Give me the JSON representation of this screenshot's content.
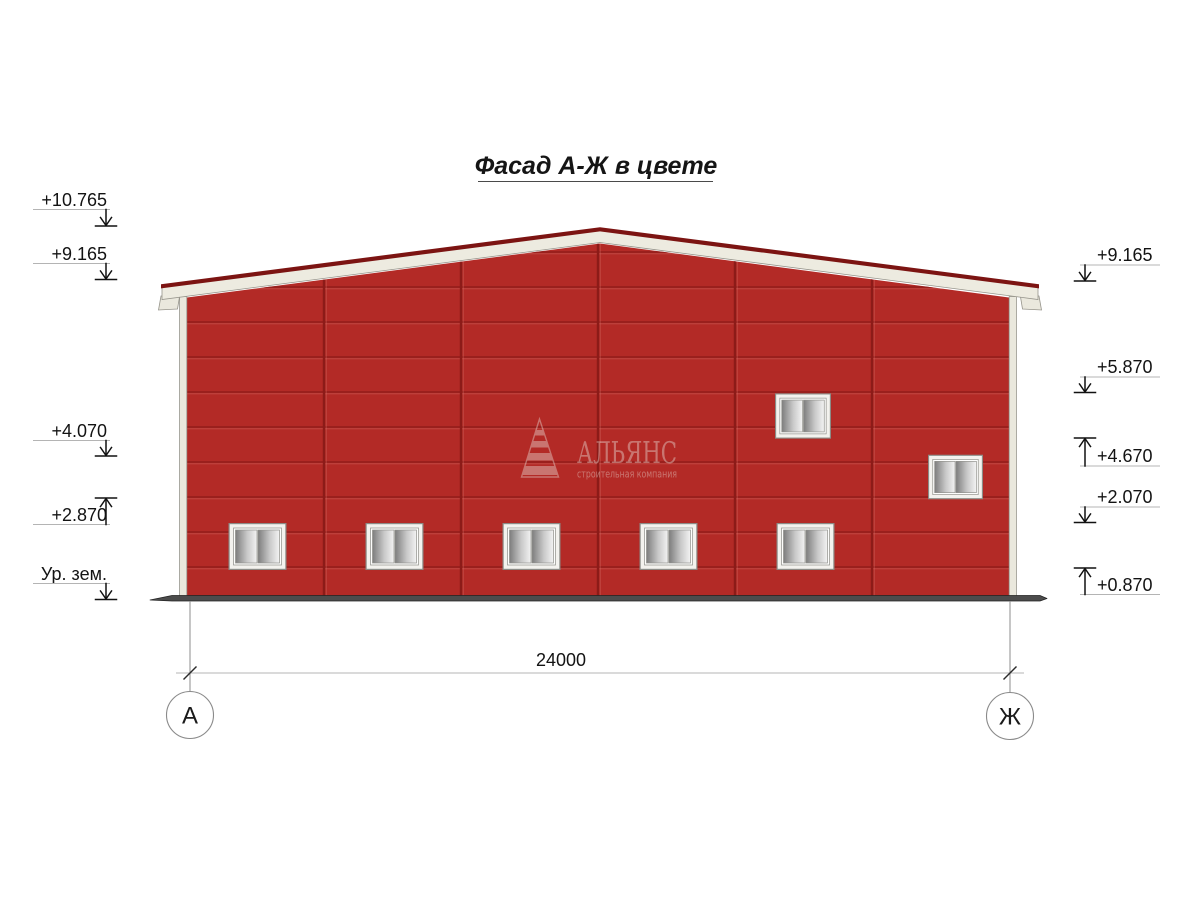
{
  "title": "Фасад А-Ж в цвете",
  "watermark": {
    "name": "АЛЬЯНС",
    "subtitle": "строительная компания"
  },
  "elevation_markers": {
    "left": [
      {
        "label": "+10.765",
        "direction": "down"
      },
      {
        "label": "+9.165",
        "direction": "down"
      },
      {
        "label": "+4.070",
        "direction": "down"
      },
      {
        "label": "+2.870",
        "direction": "up"
      },
      {
        "label": "Ур. зем.",
        "direction": "down"
      }
    ],
    "right": [
      {
        "label": "+9.165",
        "direction": "down"
      },
      {
        "label": "+5.870",
        "direction": "down"
      },
      {
        "label": "+4.670",
        "direction": "up"
      },
      {
        "label": "+2.070",
        "direction": "down"
      },
      {
        "label": "+0.870",
        "direction": "up"
      }
    ]
  },
  "dimension": {
    "total_width": "24000"
  },
  "axes": {
    "left": "А",
    "right": "Ж"
  },
  "colors": {
    "facade_red": "#b32a26",
    "seam_dark_red": "#8c1b18",
    "ridge_dark_red": "#7c1412",
    "fascia_cream": "#edebe0",
    "trim_cream": "#eae8dd",
    "ground_gray": "#4c4c4c",
    "line_gray": "#b4b4b4",
    "ink": "#131313",
    "watermark_tint": "#e9ddd6"
  }
}
